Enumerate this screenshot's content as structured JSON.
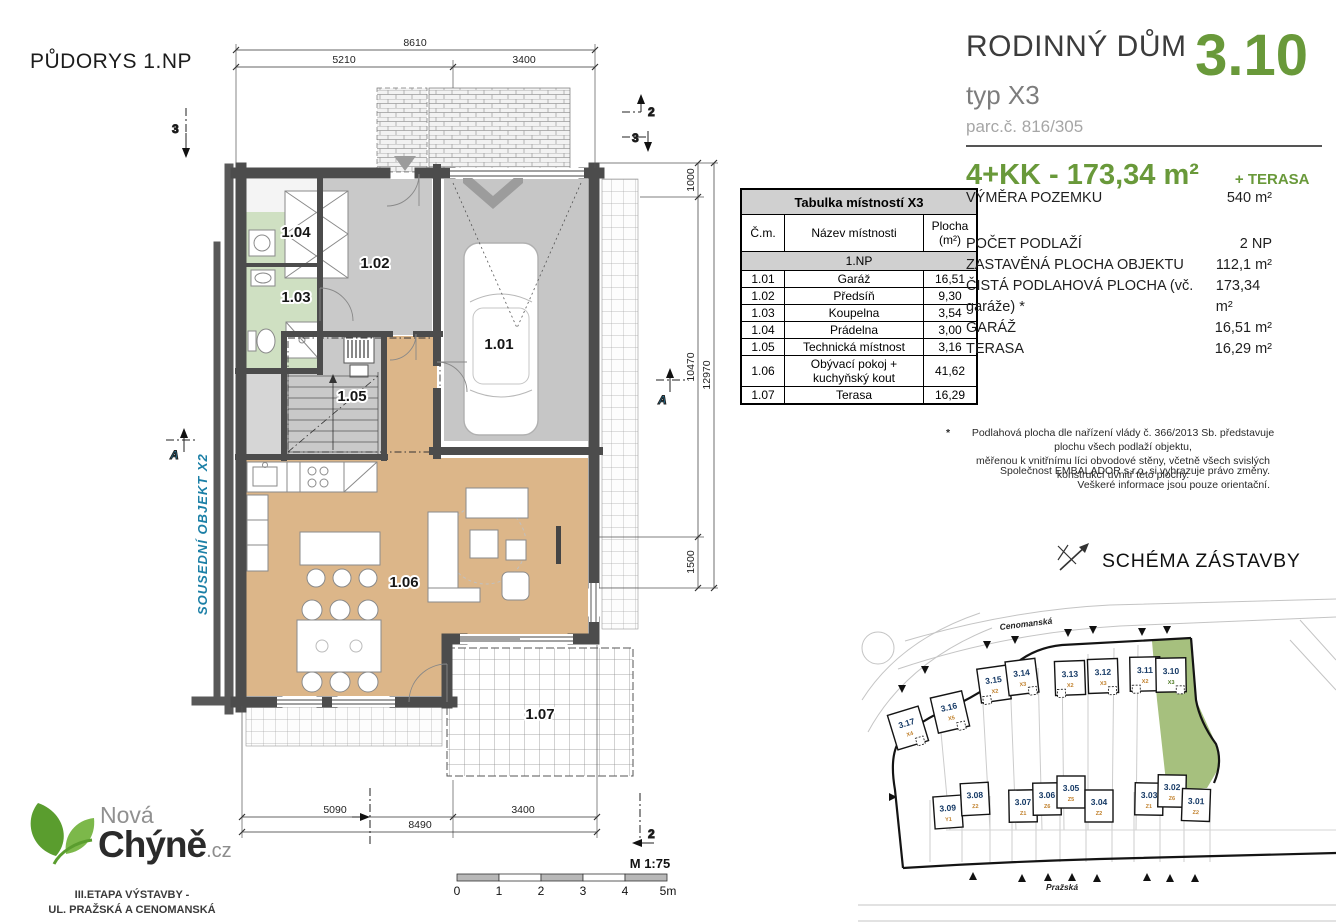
{
  "accent_green": "#69993a",
  "title": "PŮDORYS 1.NP",
  "neighbor_label": "SOUSEDNÍ OBJEKT X2",
  "header": {
    "name": "RODINNÝ DŮM",
    "number": "3.10",
    "type": "typ X3",
    "parcel": "parc.č. 816/305",
    "size": "4+KK - 173,34 m²",
    "size_suffix": "+ TERASA"
  },
  "details": {
    "rows": [
      {
        "label": "VÝMĚRA POZEMKU",
        "value": "540 m²"
      },
      {
        "label": "POČET PODLAŽÍ",
        "value": "2 NP"
      },
      {
        "label": "ZASTAVĚNÁ PLOCHA OBJEKTU",
        "value": "112,1 m²"
      },
      {
        "label": "ČISTÁ PODLAHOVÁ PLOCHA (vč. garáže) *",
        "value": "173,34 m²"
      },
      {
        "label": "GARÁŽ",
        "value": "16,51 m²"
      },
      {
        "label": "TERASA",
        "value": "16,29 m²"
      }
    ]
  },
  "footnote": {
    "star": "*",
    "line1": "Podlahová plocha dle nařízení vlády č. 366/2013 Sb. představuje plochu všech podlaží objektu,",
    "line2": "měřenou k vnitřnímu líci obvodové stěny, včetně všech svislých konstrukcí uvnitř této plochy.",
    "rights1": "Společnost EMBALADOR s.r.o. si vyhrazuje právo změny.",
    "rights2": "Veškeré informace jsou pouze orientační."
  },
  "room_table": {
    "title": "Tabulka místností X3",
    "col_cm": "Č.m.",
    "col_name": "Název místnosti",
    "col_area": "Plocha\n(m²)",
    "section": "1.NP",
    "rows": [
      {
        "cm": "1.01",
        "name": "Garáž",
        "area": "16,51"
      },
      {
        "cm": "1.02",
        "name": "Předsíň",
        "area": "9,30"
      },
      {
        "cm": "1.03",
        "name": "Koupelna",
        "area": "3,54"
      },
      {
        "cm": "1.04",
        "name": "Prádelna",
        "area": "3,00"
      },
      {
        "cm": "1.05",
        "name": "Technická místnost",
        "area": "3,16"
      },
      {
        "cm": "1.06",
        "name": "Obývací pokoj +\nkuchyňský kout",
        "area": "41,62"
      },
      {
        "cm": "1.07",
        "name": "Terasa",
        "area": "16,29"
      }
    ]
  },
  "plan": {
    "room_labels": [
      "1.01",
      "1.02",
      "1.03",
      "1.04",
      "1.05",
      "1.06",
      "1.07"
    ],
    "dims": {
      "top_total": "8610",
      "top_left": "5210",
      "top_right": "3400",
      "right_top": "1000",
      "right_mid": "10470",
      "right_low": "1500",
      "right_total": "12970",
      "bot_left": "5090",
      "bot_right": "3400",
      "bot_total": "8490"
    },
    "sections": {
      "two": "2",
      "three": "3",
      "a": "A"
    },
    "scale_label": "M 1:75",
    "scale_ticks": [
      "0",
      "1",
      "2",
      "3",
      "4",
      "5m"
    ]
  },
  "site": {
    "heading": "SCHÉMA ZÁSTAVBY",
    "street_top": "Cenomanská",
    "street_bottom": "Pražská",
    "highlight_green": "#a6c07e",
    "top_row": [
      {
        "num": "3.17",
        "type": "X4"
      },
      {
        "num": "3.16",
        "type": "X5"
      },
      {
        "num": "3.15",
        "type": "X2"
      },
      {
        "num": "3.14",
        "type": "X3"
      },
      {
        "num": "3.13",
        "type": "X2"
      },
      {
        "num": "3.12",
        "type": "X3"
      },
      {
        "num": "3.11",
        "type": "X2"
      },
      {
        "num": "3.10",
        "type": "X3"
      }
    ],
    "bottom_row": [
      {
        "num": "3.09",
        "type": "Y1"
      },
      {
        "num": "3.08",
        "type": "Z2"
      },
      {
        "num": "3.07",
        "type": "Z1"
      },
      {
        "num": "3.06",
        "type": "Z6"
      },
      {
        "num": "3.05",
        "type": "Z5"
      },
      {
        "num": "3.04",
        "type": "Z2"
      },
      {
        "num": "3.03",
        "type": "Z1"
      },
      {
        "num": "3.02",
        "type": "Z6"
      },
      {
        "num": "3.01",
        "type": "Z2"
      }
    ]
  },
  "logo": {
    "line1": "Nová",
    "line2": "Chýně",
    "suffix": ".cz",
    "etapa1": "III.ETAPA VÝSTAVBY -",
    "etapa2": "UL. PRAŽSKÁ A CENOMANSKÁ"
  }
}
